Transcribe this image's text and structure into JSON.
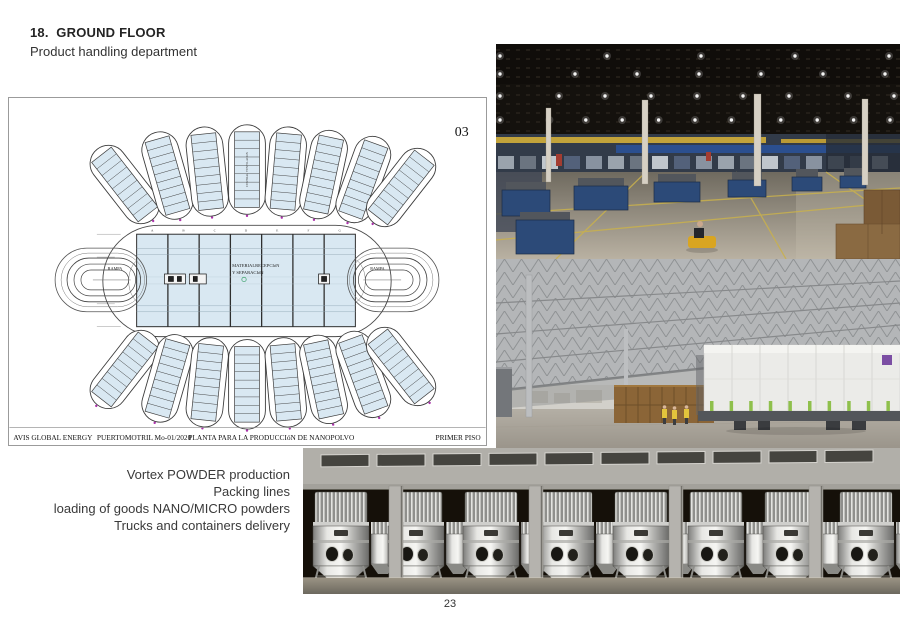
{
  "page": {
    "number": "23"
  },
  "header": {
    "title": "18.  GROUND FLOOR",
    "subtitle": "Product handling department"
  },
  "caption": {
    "lines": [
      "Vortex POWDER production",
      "Packing lines",
      "loading of goods NANO/MICRO powders",
      "Trucks and containers delivery"
    ]
  },
  "floor_plan": {
    "sheet_number": "03",
    "grid_letters": [
      "A",
      "B",
      "C",
      "D",
      "E",
      "F",
      "G"
    ],
    "center_label_line1": "MATERIALRECEPCIóN",
    "center_label_line2": "Y SEPARACIóN",
    "ramp_label_left": "RAMPA",
    "ramp_label_right": "RAMPA",
    "pod_vertical_label": "CENTRAL VENTILACIóN",
    "footer": {
      "company": "AVIS GLOBAL ENERGY",
      "location": "PUERTOMOTRIL  Mo-01/2020",
      "drawing_title": "PLANTA PARA LA PRODUCCIóN DE NANOPOLVO",
      "sheet_name": "PRIMER PISO"
    },
    "colors": {
      "room_fill": "#d9e8f2",
      "line": "#3c3c3c"
    }
  }
}
